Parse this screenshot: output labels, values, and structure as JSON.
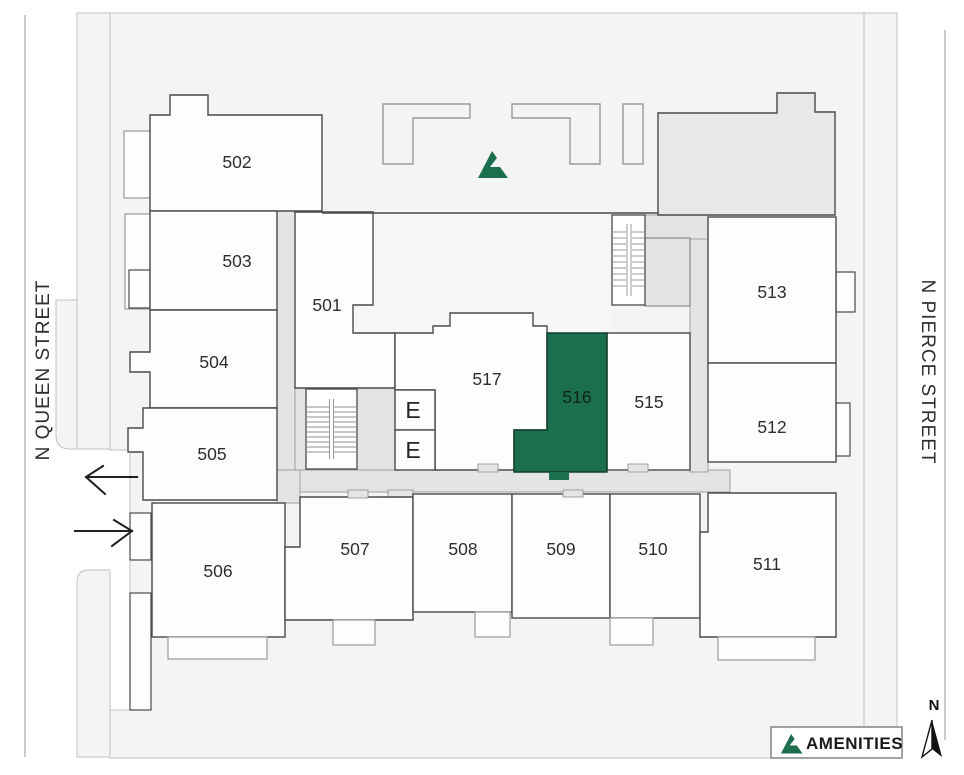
{
  "page": {
    "type": "building-site-plan",
    "floor_hint": "5th floor units"
  },
  "streets": {
    "left": "N QUEEN STREET",
    "right": "N PIERCE STREET"
  },
  "units": [
    {
      "id": "501",
      "label": "501",
      "highlighted": false
    },
    {
      "id": "502",
      "label": "502",
      "highlighted": false
    },
    {
      "id": "503",
      "label": "503",
      "highlighted": false
    },
    {
      "id": "504",
      "label": "504",
      "highlighted": false
    },
    {
      "id": "505",
      "label": "505",
      "highlighted": false
    },
    {
      "id": "506",
      "label": "506",
      "highlighted": false
    },
    {
      "id": "507",
      "label": "507",
      "highlighted": false
    },
    {
      "id": "508",
      "label": "508",
      "highlighted": false
    },
    {
      "id": "509",
      "label": "509",
      "highlighted": false
    },
    {
      "id": "510",
      "label": "510",
      "highlighted": false
    },
    {
      "id": "511",
      "label": "511",
      "highlighted": false
    },
    {
      "id": "512",
      "label": "512",
      "highlighted": false
    },
    {
      "id": "513",
      "label": "513",
      "highlighted": false
    },
    {
      "id": "515",
      "label": "515",
      "highlighted": false
    },
    {
      "id": "516",
      "label": "516",
      "highlighted": true
    },
    {
      "id": "517",
      "label": "517",
      "highlighted": false
    }
  ],
  "highlighted_unit": "516",
  "elevator": {
    "label": "E",
    "count": 2
  },
  "legend": {
    "label": "AMENITIES"
  },
  "compass": {
    "label": "N"
  },
  "colors": {
    "amenity_green": "#1b6e4e",
    "unit_fill": "#fdfdfd",
    "corridor_gray": "#e4e4e4",
    "lot_gray": "#f4f4f4",
    "annex_gray": "#e8e8e8"
  }
}
